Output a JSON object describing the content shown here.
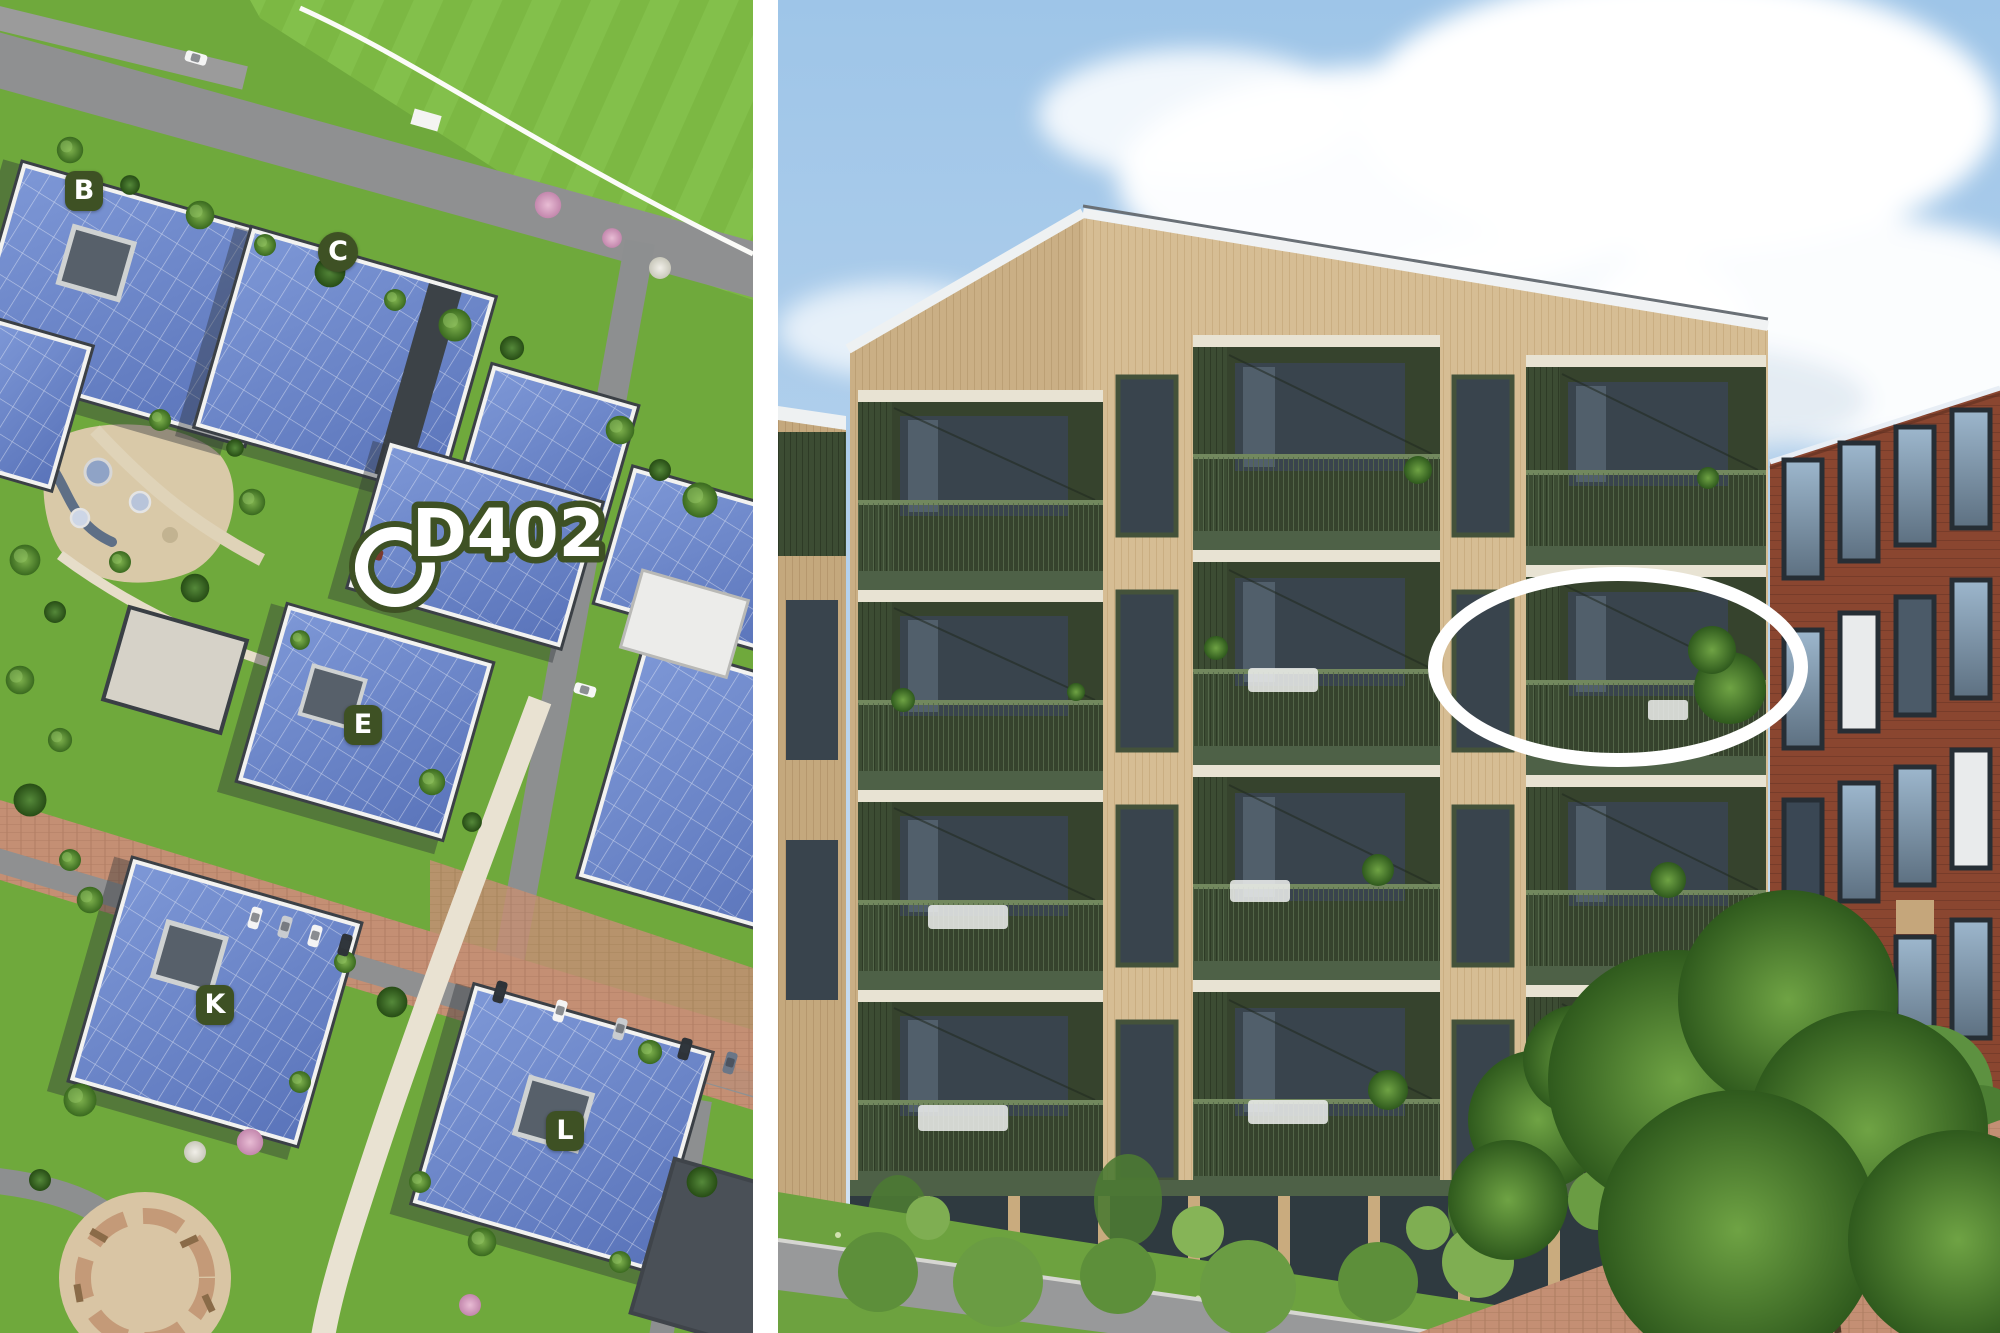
{
  "site_plan": {
    "building_badges": [
      {
        "label": "B"
      },
      {
        "label": "C"
      },
      {
        "label": "E"
      },
      {
        "label": "K"
      },
      {
        "label": "L"
      }
    ],
    "unit_marker": {
      "label": "D402"
    }
  },
  "photo": {
    "highlight": {
      "shape": "ellipse",
      "color": "#ffffff"
    }
  },
  "colors": {
    "badge_green": "#3e5124",
    "marker_white": "#ffffff",
    "solar_roof_blue": "#6583c9",
    "grass_green": "#6fa93c",
    "lawn_green": "#7cb843",
    "road_gray": "#8f9091",
    "footpath_beige": "#e9e2d2",
    "brick_paving": "#c48f74",
    "sky_blue": "#9ec5e8",
    "timber_facade": "#d6bd94",
    "balcony_recess_green": "#36432d",
    "balcony_slat_green": "#3c4c33",
    "brick_building_red": "#8a4630",
    "highlight_white": "#ffffff"
  }
}
